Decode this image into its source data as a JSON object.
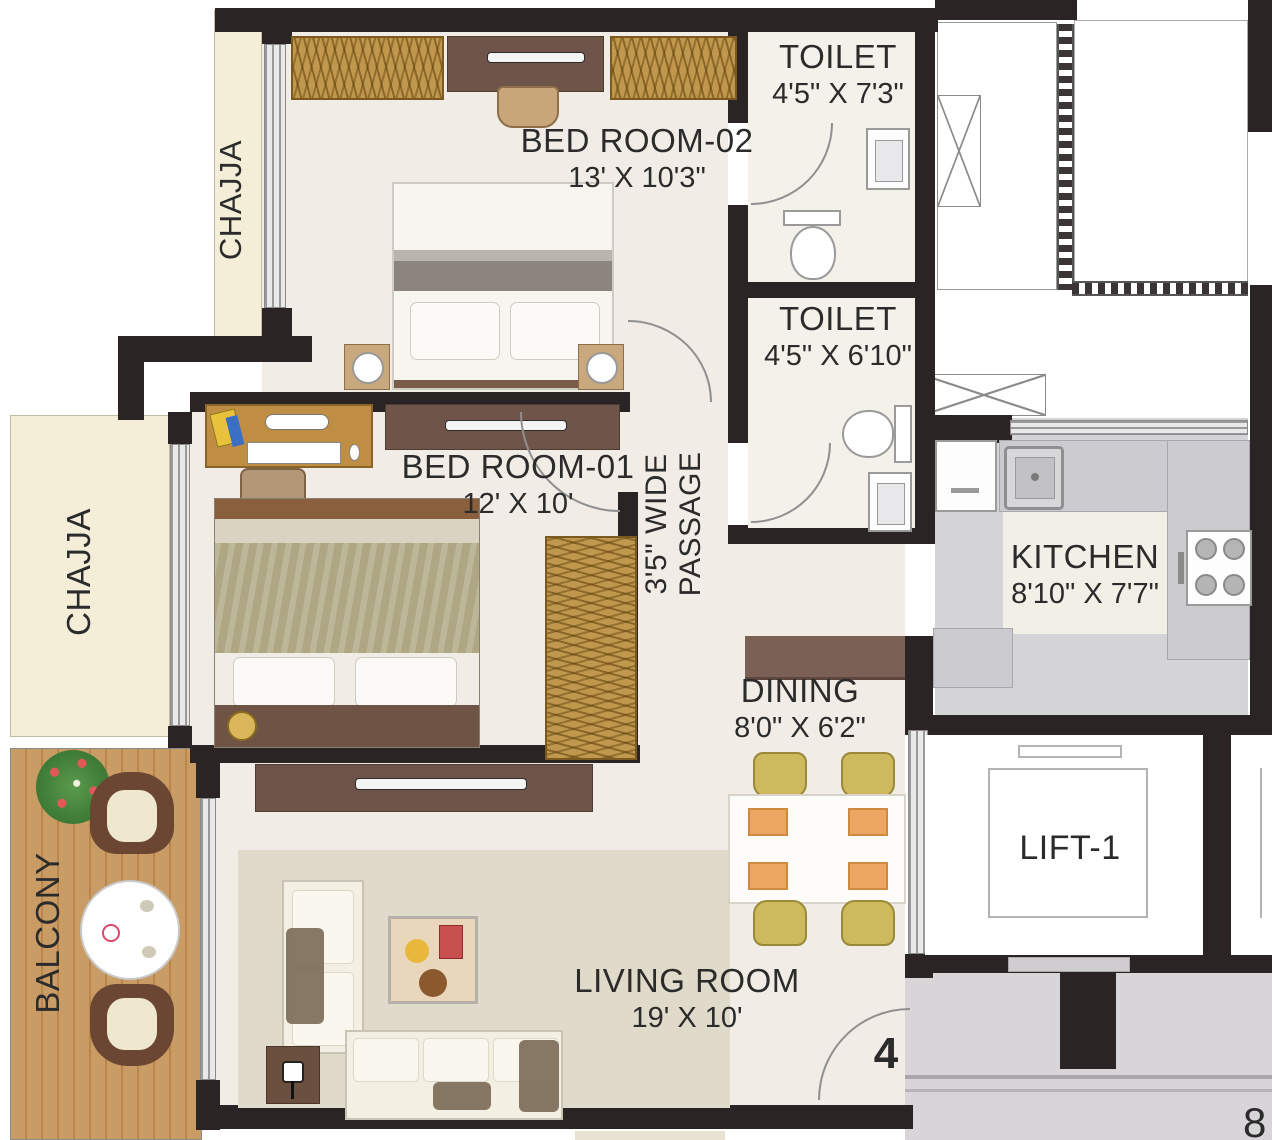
{
  "rooms": {
    "bedroom2": {
      "name": "BED ROOM-02",
      "dims": "13' X 10'3\""
    },
    "toilet1": {
      "name": "TOILET",
      "dims": "4'5\" X 7'3\""
    },
    "toilet2": {
      "name": "TOILET",
      "dims": "4'5\" X 6'10\""
    },
    "bedroom1": {
      "name": "BED ROOM-01",
      "dims": "12' X 10'"
    },
    "passage": {
      "line1": "3'5\" WIDE",
      "line2": "PASSAGE"
    },
    "kitchen": {
      "name": "KITCHEN",
      "dims": "8'10\" X 7'7\""
    },
    "dining": {
      "name": "DINING",
      "dims": "8'0\" X 6'2\""
    },
    "living": {
      "name": "LIVING ROOM",
      "dims": "19' X 10'"
    },
    "lift1": {
      "name": "LIFT-1"
    },
    "balcony": {
      "name": "BALCONY"
    },
    "chajja_top": {
      "name": "CHAJJA"
    },
    "chajja_left": {
      "name": "CHAJJA"
    }
  },
  "annotations": {
    "unit_number": "4",
    "edge_number": "8"
  },
  "colors": {
    "wall": "#2a2425",
    "floor": "#f1ede6",
    "chajja": "#f4eed8",
    "balcony_wood": "#c99c66",
    "wardrobe": "#bf984e",
    "dark_furniture": "#6f5549",
    "kitchen_counter": "#cbcacf",
    "corridor": "#d8d5d8",
    "dining_chair": "#cdb95e",
    "placemat": "#eda763"
  }
}
